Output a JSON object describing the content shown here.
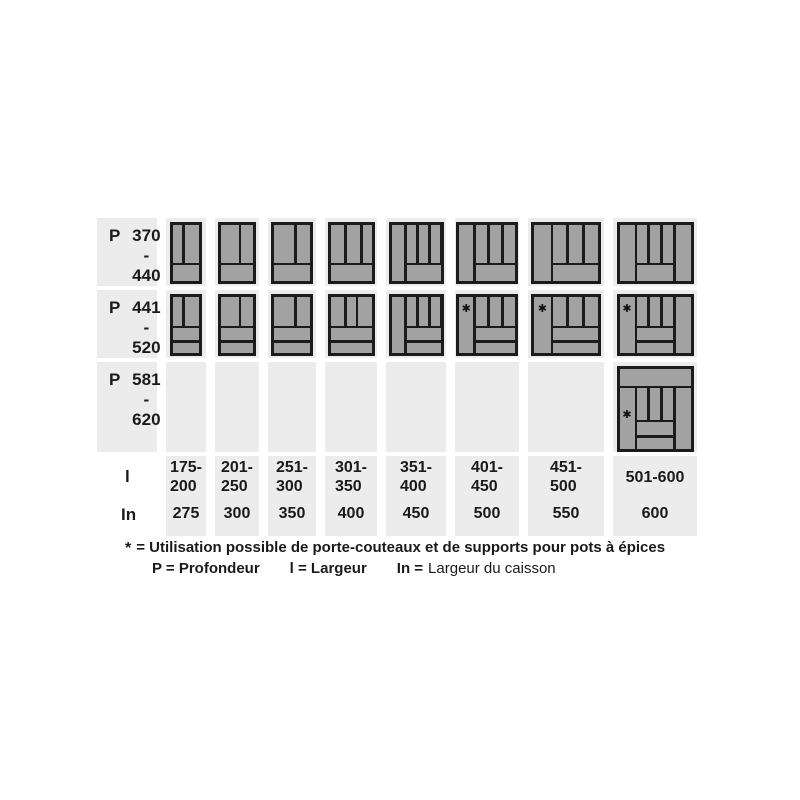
{
  "colors": {
    "page_background": "#ffffff",
    "column_band": "#ececec",
    "tray_border": "#1b1b1b",
    "tray_compartment": "#a2a2a2",
    "text": "#1a1a1a"
  },
  "table": {
    "star_glyph": "✱",
    "label_col_width": 60,
    "columns": [
      {
        "id": "c1",
        "band_width": 40,
        "tray_width": 32,
        "range_lines": [
          "175-",
          "200"
        ],
        "cabinet": "275"
      },
      {
        "id": "c2",
        "band_width": 44,
        "tray_width": 38,
        "range_lines": [
          "201-",
          "250"
        ],
        "cabinet": "300"
      },
      {
        "id": "c3",
        "band_width": 48,
        "tray_width": 42,
        "range_lines": [
          "251-",
          "300"
        ],
        "cabinet": "350"
      },
      {
        "id": "c4",
        "band_width": 52,
        "tray_width": 47,
        "range_lines": [
          "301-",
          "350"
        ],
        "cabinet": "400"
      },
      {
        "id": "c5",
        "band_width": 60,
        "tray_width": 55,
        "range_lines": [
          "351-",
          "400"
        ],
        "cabinet": "450"
      },
      {
        "id": "c6",
        "band_width": 64,
        "tray_width": 62,
        "range_lines": [
          "401-",
          "450"
        ],
        "cabinet": "500"
      },
      {
        "id": "c7",
        "band_width": 76,
        "tray_width": 70,
        "range_lines": [
          "451-",
          "500"
        ],
        "cabinet": "550"
      },
      {
        "id": "c8",
        "band_width": 84,
        "tray_width": 77,
        "range_lines": [
          "501-600"
        ],
        "cabinet": "600"
      }
    ],
    "rows": [
      {
        "id": "r1",
        "height": 68,
        "tray_height": 62,
        "label": {
          "prefix": "P",
          "from": "370",
          "dash": "-",
          "to": "440"
        },
        "trays": {
          "c1": {
            "verticals": [
              2,
              3
            ],
            "bottoms": 1
          },
          "c2": {
            "verticals": [
              3,
              2
            ],
            "bottoms": 1
          },
          "c3": {
            "verticals": [
              3,
              2
            ],
            "bottoms": 1
          },
          "c4": {
            "verticals": [
              3,
              3,
              2
            ],
            "bottoms": 1
          },
          "c5": {
            "left": true,
            "verticals": [
              1,
              1,
              1
            ],
            "bottoms": 1
          },
          "c6": {
            "left": true,
            "verticals": [
              1,
              1,
              1
            ],
            "bottoms": 1
          },
          "c7": {
            "left": true,
            "verticals": [
              1,
              1,
              1
            ],
            "bottoms": 1
          },
          "c8": {
            "left": true,
            "right": true,
            "verticals": [
              1,
              1,
              1
            ],
            "bottoms": 1
          }
        }
      },
      {
        "id": "r2",
        "height": 68,
        "tray_height": 62,
        "label": {
          "prefix": "P",
          "from": "441",
          "dash": "-",
          "to": "520"
        },
        "trays": {
          "c1": {
            "verticals": [
              2,
              3
            ],
            "bottoms": 2
          },
          "c2": {
            "verticals": [
              3,
              2
            ],
            "bottoms": 2
          },
          "c3": {
            "verticals": [
              3,
              2
            ],
            "bottoms": 2
          },
          "c4": {
            "verticals": [
              3,
              2,
              3
            ],
            "bottoms": 2
          },
          "c5": {
            "left": true,
            "verticals": [
              1,
              1,
              1
            ],
            "bottoms": 2
          },
          "c6": {
            "left": true,
            "star": true,
            "star_pos": "top",
            "verticals": [
              1,
              1,
              1
            ],
            "bottoms": 2
          },
          "c7": {
            "left": true,
            "star": true,
            "star_pos": "top",
            "verticals": [
              1,
              1,
              1
            ],
            "bottoms": 2
          },
          "c8": {
            "left": true,
            "right": true,
            "star": true,
            "star_pos": "top",
            "verticals": [
              1,
              1,
              1
            ],
            "bottoms": 2
          }
        }
      },
      {
        "id": "r3",
        "height": 90,
        "tray_height": 86,
        "label": {
          "prefix": "P",
          "from": "581",
          "dash": "-",
          "to": "620"
        },
        "trays": {
          "c8": {
            "top_strip": true,
            "left": true,
            "right": true,
            "star": true,
            "star_pos": "mid",
            "verticals": [
              1,
              1,
              1
            ],
            "bottoms": 2
          }
        }
      }
    ],
    "dims": {
      "height": 80,
      "l_label": "l",
      "in_label": "In"
    }
  },
  "footnote": {
    "star": "*",
    "text": "= Utilisation possible de porte-couteaux et de supports pour pots à épices"
  },
  "legend": [
    {
      "bold": "P = Profondeur",
      "regular": ""
    },
    {
      "bold": "l = Largeur",
      "regular": ""
    },
    {
      "bold": "In =",
      "regular": "Largeur du caisson"
    }
  ]
}
